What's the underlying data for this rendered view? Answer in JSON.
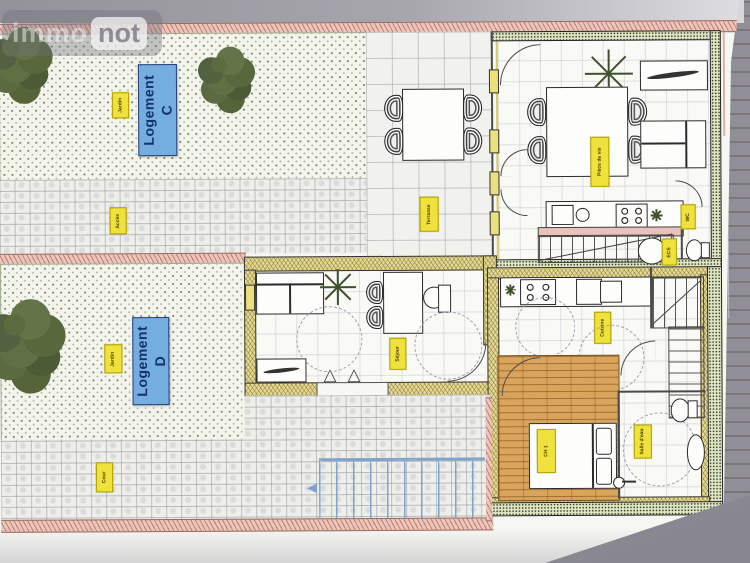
{
  "document_type": "architectural floor plan photo",
  "watermark": {
    "brand_left": "immo",
    "brand_right": "not"
  },
  "units": {
    "c": {
      "label_line1": "Logement",
      "label_line2": "C"
    },
    "d": {
      "label_line1": "Logement",
      "label_line2": "D"
    }
  },
  "room_labels": {
    "garden_c": "Jardin",
    "path": "Accès",
    "terrace": "Terrasse",
    "living_c": "Pièce de vie",
    "wc_c": "WC",
    "heater_c": "ECS",
    "garden_d": "Jardin",
    "living_d": "Séjour",
    "kitchen_d": "Cuisine",
    "bedroom_d": "CH 1",
    "bath_d": "Salle d'eau",
    "court": "Cour"
  },
  "colors": {
    "background": "#908f97",
    "wood": "#85664a",
    "paper": "#f6f6f2",
    "boundary": "#ecc5bb",
    "wall_yellow": "#e9da85",
    "wall_green": "#dfe4c6",
    "garden": "#f3f5ec",
    "label_yellow": "#f0e23c",
    "label_blue": "#74aede",
    "label_blue_text": "#15306b",
    "wood_floor": "#d9a45c",
    "ramp": "#7fa3cc"
  }
}
